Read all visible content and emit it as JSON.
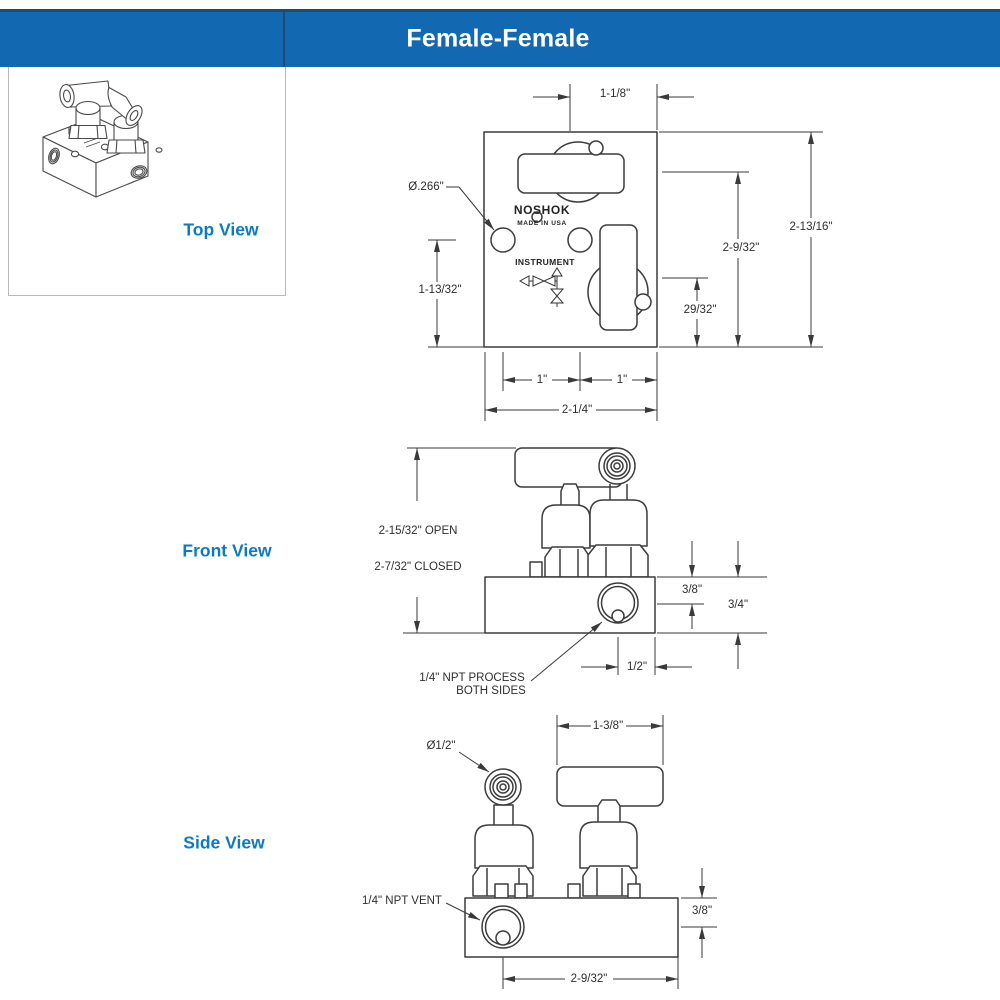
{
  "header": {
    "title": "Female-Female"
  },
  "views": {
    "top": "Top View",
    "front": "Front View",
    "side": "Side View"
  },
  "brand": {
    "logo": "NOSHOK",
    "made_in": "MADE IN USA",
    "schematic": "INSTRUMENT"
  },
  "top_view_dims": {
    "center_to_edge": "1-1/8\"",
    "hole_dia": "Ø.266\"",
    "ports_height": "1-13/32\"",
    "outlet_height": "29/32\"",
    "handle_height": "2-9/32\"",
    "overall_depth": "2-13/16\"",
    "left_spacing": "1\"",
    "right_spacing": "1\"",
    "overall_width": "2-1/4\""
  },
  "front_view_dims": {
    "open": "2-15/32\" OPEN",
    "closed": "2-7/32\" CLOSED",
    "top_to_port": "3/8\"",
    "body_height": "3/4\"",
    "port_offset": "1/2\"",
    "process_line1": "1/4\" NPT PROCESS",
    "process_line2": "BOTH SIDES"
  },
  "side_view_dims": {
    "handle_dia": "Ø1/2\"",
    "handle_width": "1-3/8\"",
    "vent_label": "1/4\" NPT VENT",
    "top_to_vent": "3/8\"",
    "vent_offset": "2-9/32\""
  }
}
